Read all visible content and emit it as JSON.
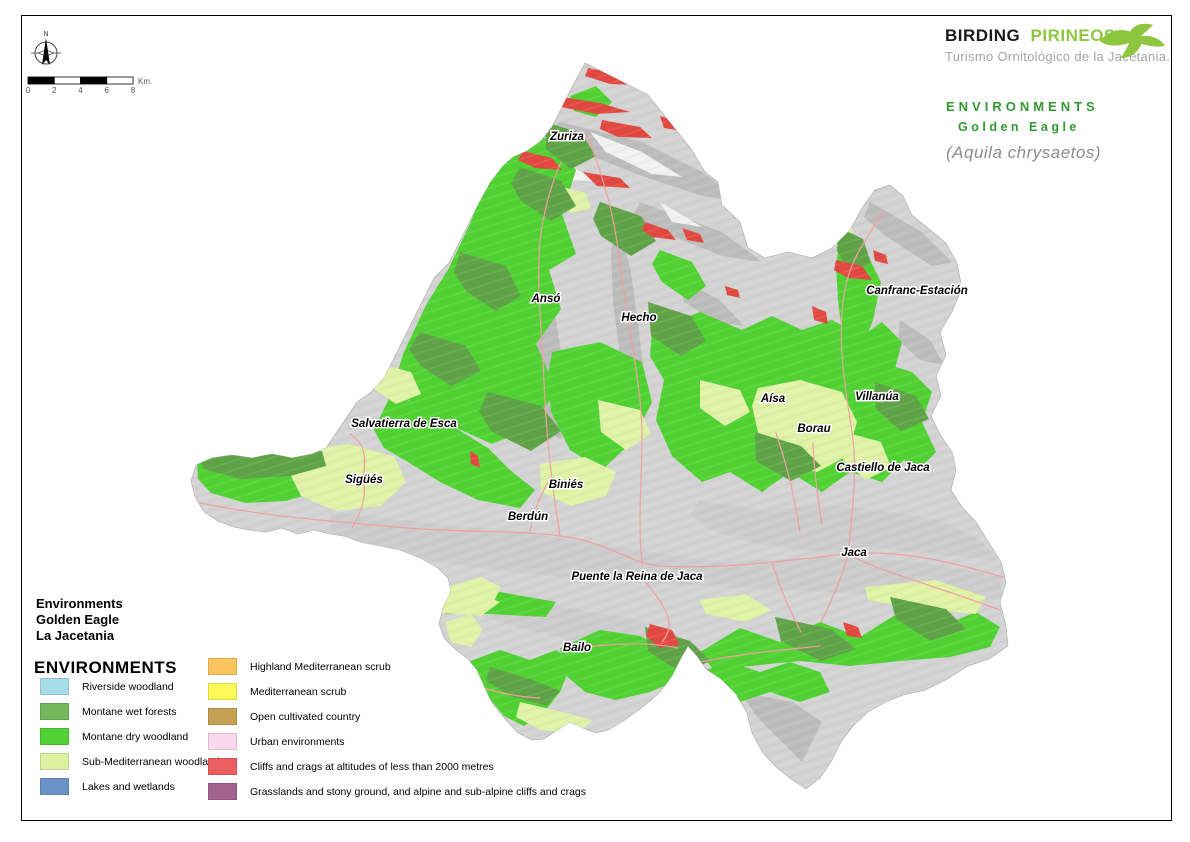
{
  "branding": {
    "name_black": "BIRDING",
    "name_green": "PIRINEOS",
    "tagline": "Turismo Ornitológico de la Jacetania.",
    "brand_green": "#8dc63f",
    "tagline_gray": "#a5a5a5"
  },
  "title": {
    "line1": "ENVIRONMENTS",
    "line2": "Golden Eagle",
    "species_latin": "(Aquila chrysaetos)",
    "green": "#339933",
    "gray": "#8c8c8c"
  },
  "compass": {
    "north_label": "N"
  },
  "scalebar": {
    "ticks": [
      "0",
      "2",
      "4",
      "6",
      "8"
    ],
    "unit": "Km."
  },
  "map": {
    "places": [
      {
        "name": "Zuriza"
      },
      {
        "name": "Ansó"
      },
      {
        "name": "Hecho"
      },
      {
        "name": "Canfranc-Estación"
      },
      {
        "name": "Aísa"
      },
      {
        "name": "Villanúa"
      },
      {
        "name": "Borau"
      },
      {
        "name": "Castiello de Jaca"
      },
      {
        "name": "Jaca"
      },
      {
        "name": "Salvatierra de Esca"
      },
      {
        "name": "Sigüés"
      },
      {
        "name": "Biniés"
      },
      {
        "name": "Berdún"
      },
      {
        "name": "Puente la Reina de Jaca"
      },
      {
        "name": "Bailo"
      }
    ]
  },
  "map_colors": {
    "terrain": "#d3d3d3",
    "terrain_shade": "#bcbcbc",
    "valley_shade": "#cdcdcd",
    "highlight": "#f2f2f2",
    "dry_woodland": "#4fd231",
    "wet_forest": "#5ea345",
    "sub_mediterranean": "#dff2a6",
    "cliffs": "#e2473f",
    "roads": "#f0a0a0"
  },
  "legend": {
    "title_lines": [
      "Environments",
      "Golden Eagle",
      "La Jacetania"
    ],
    "header": "ENVIRONMENTS",
    "left_items": [
      {
        "label": "Riverside woodland",
        "color": "#a5dee9"
      },
      {
        "label": "Montane wet forests",
        "color": "#76b95c"
      },
      {
        "label": "Montane dry woodland",
        "color": "#52d236"
      },
      {
        "label": "Sub-Mediterranean woodland",
        "color": "#dcf2a0"
      },
      {
        "label": "Lakes and wetlands",
        "color": "#6a92c9"
      }
    ],
    "right_items": [
      {
        "label": "Highland Mediterranean scrub",
        "color": "#f9c45e"
      },
      {
        "label": "Mediterranean scrub",
        "color": "#fbf957"
      },
      {
        "label": "Open cultivated country",
        "color": "#c4a155"
      },
      {
        "label": "Urban environments",
        "color": "#fbd8ee"
      },
      {
        "label": "Cliffs and crags at altitudes of less than 2000 metres",
        "color": "#eb5e61"
      },
      {
        "label": "Grasslands and stony ground, and alpine and sub-alpine cliffs and crags",
        "color": "#a5628e"
      }
    ]
  }
}
